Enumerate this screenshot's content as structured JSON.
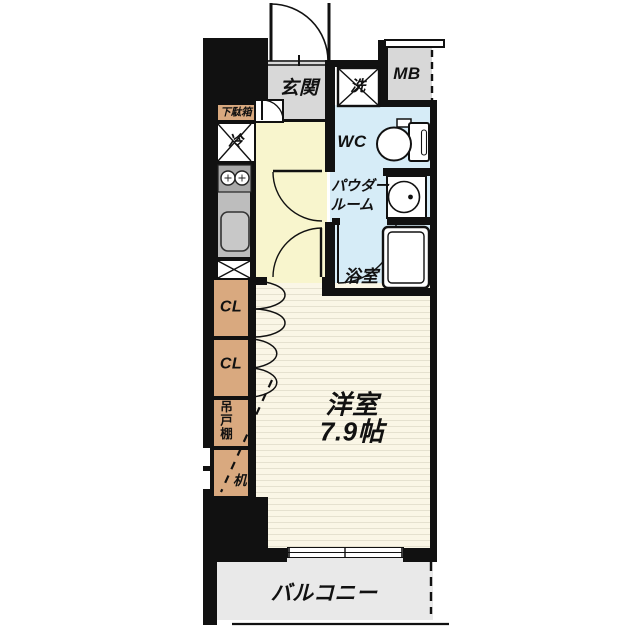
{
  "floorplan": {
    "labels": {
      "entrance": "玄関",
      "washer": "洗",
      "meter_box": "MB",
      "toilet": "WC",
      "powder_room_line1": "パウダー",
      "powder_room_line2": "ルーム",
      "bathroom": "浴室",
      "shoe_cabinet": "下駄箱",
      "refrigerator": "冷",
      "closet_upper": "CL",
      "closet_lower": "CL",
      "hanging_cupboard": "吊戸棚",
      "desk": "机",
      "main_room_name": "洋室",
      "main_room_size": "7.9帖",
      "balcony": "バルコニー"
    },
    "colors": {
      "wall": "#111111",
      "entrance_floor": "#d8d8d8",
      "corridor_floor": "#f8f5cd",
      "wet_area_floor": "#d6ecf7",
      "main_room_floor": "#faf6e6",
      "storage_tan": "#d9a97f",
      "balcony_floor": "#e9e9e9",
      "kitchen_counter": "#bdbdbd"
    }
  }
}
